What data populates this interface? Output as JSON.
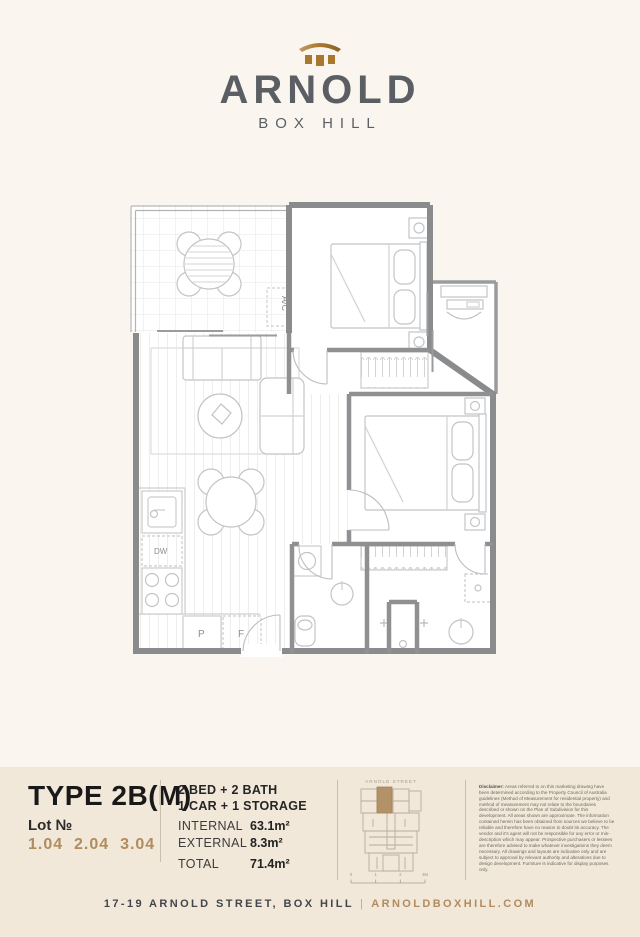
{
  "logo": {
    "name": "ARNOLD",
    "location": "BOX HILL"
  },
  "plan": {
    "labels": {
      "ac": "A/C",
      "dw": "DW",
      "p": "P",
      "f": "F"
    }
  },
  "info": {
    "type_title": "TYPE 2B(M)",
    "lot_label": "Lot №",
    "lot_numbers": "1.04  2.04  3.04",
    "config_line1": "2 BED + 2 BATH",
    "config_line2": "1 CAR + 1 STORAGE",
    "areas": [
      {
        "label": "INTERNAL",
        "value": "63.1m²"
      },
      {
        "label": "EXTERNAL",
        "value": "8.3m²"
      },
      {
        "label": "TOTAL",
        "value": "71.4m²"
      }
    ],
    "minimap": {
      "street": "ARNOLD STREET",
      "scale_ticks": [
        "0",
        "1",
        "2",
        "3M"
      ]
    },
    "disclaimer_title": "Disclaimer:",
    "disclaimer_text": "Areas referred to on this marketing drawing have been determined according to the Property Council of Australia guidelines (Method of Measurement for residential property) and method of measurement may not relate to the boundaries described or shown on the Plan of Subdivision for this development. All areas shown are approximate. The information contained herein has been obtained from sources we believe to be reliable and therefore have no reason to doubt its accuracy. The vendor and it's agent will not be responsible for any error or mis-description which may appear. Prospective purchasers or lessees are therefore advised to make whatever investigations they deem necessary. All drawings and layouts are indicative only and are subject to approval by relevant authority and alterations due to design development. Furniture is indicative for display purposes only."
  },
  "footer": {
    "address": "17-19 ARNOLD STREET, BOX HILL",
    "separator": "|",
    "website": "ARNOLDBOXHILL.COM"
  },
  "colors": {
    "brand_brown": "#a9772e",
    "accent_tan": "#b08c5e",
    "logo_gray": "#5b5f64",
    "wall_gray": "#8a8b8d",
    "page_cream": "#faf6ef",
    "band_cream": "#f1e8da",
    "minimap_highlight": "#b49268"
  }
}
